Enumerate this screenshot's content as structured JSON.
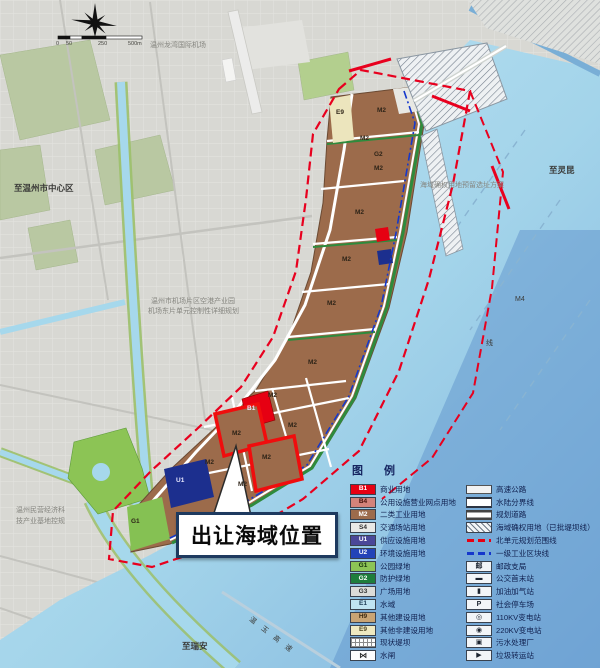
{
  "callout": {
    "text": "出让海域位置"
  },
  "scalebar": {
    "labels": [
      "0",
      "50",
      "250",
      "500m"
    ]
  },
  "map_labels": [
    {
      "text": "温州龙湾国际机场",
      "x": 150,
      "y": 42,
      "cls": "tiny gray"
    },
    {
      "text": "至灵昆",
      "x": 549,
      "y": 166,
      "cls": "small dark"
    },
    {
      "text": "至温州市中心区",
      "x": 14,
      "y": 184,
      "cls": "small dark"
    },
    {
      "text": "温州市机场片区空港产业园",
      "x": 151,
      "y": 298,
      "cls": "tiny gray"
    },
    {
      "text": "机场东片单元控制性详细规划",
      "x": 148,
      "y": 308,
      "cls": "tiny gray"
    },
    {
      "text": "温州民营经济科",
      "x": 16,
      "y": 507,
      "cls": "tiny gray"
    },
    {
      "text": "技产业基地控规",
      "x": 16,
      "y": 518,
      "cls": "tiny gray"
    },
    {
      "text": "至瑞安",
      "x": 182,
      "y": 642,
      "cls": "small dark"
    },
    {
      "text": "海域确权用地预留选址方案",
      "x": 420,
      "y": 182,
      "cls": "tiny gray"
    },
    {
      "text": "M4",
      "x": 515,
      "y": 296,
      "cls": "tiny dark"
    },
    {
      "text": "线",
      "x": 486,
      "y": 340,
      "cls": "tiny dark"
    },
    {
      "text": "温玉高速",
      "x": 252,
      "y": 616,
      "cls": "tiny dark",
      "rot": 38,
      "spacing": 8
    }
  ],
  "parcel_codes": [
    {
      "t": "E9",
      "x": 336,
      "y": 110
    },
    {
      "t": "M2",
      "x": 377,
      "y": 108
    },
    {
      "t": "M2",
      "x": 360,
      "y": 136
    },
    {
      "t": "G2",
      "x": 374,
      "y": 152
    },
    {
      "t": "M2",
      "x": 374,
      "y": 166
    },
    {
      "t": "M2",
      "x": 355,
      "y": 210
    },
    {
      "t": "M2",
      "x": 342,
      "y": 257
    },
    {
      "t": "M2",
      "x": 327,
      "y": 301
    },
    {
      "t": "M2",
      "x": 308,
      "y": 360
    },
    {
      "t": "M2",
      "x": 268,
      "y": 393
    },
    {
      "t": "B1",
      "x": 247,
      "y": 406,
      "light": true
    },
    {
      "t": "M2",
      "x": 288,
      "y": 423
    },
    {
      "t": "M2",
      "x": 232,
      "y": 431
    },
    {
      "t": "M2",
      "x": 262,
      "y": 455
    },
    {
      "t": "M2",
      "x": 205,
      "y": 460
    },
    {
      "t": "M2",
      "x": 238,
      "y": 482
    },
    {
      "t": "U1",
      "x": 176,
      "y": 478,
      "light": true
    },
    {
      "t": "G1",
      "x": 131,
      "y": 519
    }
  ],
  "legend": {
    "title": "图 例",
    "left": [
      {
        "code": "B1",
        "label": "商业用地",
        "swatch": "b1"
      },
      {
        "code": "B4",
        "label": "公用设施营业网点用地",
        "swatch": "b4"
      },
      {
        "code": "M2",
        "label": "二类工业用地",
        "swatch": "m2"
      },
      {
        "code": "S4",
        "label": "交通场站用地",
        "swatch": "s4"
      },
      {
        "code": "U1",
        "label": "供应设施用地",
        "swatch": "u1"
      },
      {
        "code": "U2",
        "label": "环境设施用地",
        "swatch": "u2"
      },
      {
        "code": "G1",
        "label": "公园绿地",
        "swatch": "g1"
      },
      {
        "code": "G2",
        "label": "防护绿地",
        "swatch": "g2"
      },
      {
        "code": "G3",
        "label": "广场用地",
        "swatch": "g3"
      },
      {
        "code": "E1",
        "label": "水域",
        "swatch": "e1"
      },
      {
        "code": "H9",
        "label": "其他建设用地",
        "swatch": "h9"
      },
      {
        "code": "E9",
        "label": "其他非建设用地",
        "swatch": "e9"
      },
      {
        "code": "",
        "label": "现状堤坝",
        "swatch": "dike"
      },
      {
        "code": "",
        "label": "水闸",
        "swatch": "gate",
        "glyph": "⋈"
      }
    ],
    "right": [
      {
        "label": "高速公路",
        "swatch": "highway"
      },
      {
        "label": "水陆分界线",
        "swatch": "waterline"
      },
      {
        "label": "规划道路",
        "swatch": "plannedroad"
      },
      {
        "label": "海域确权用地（已批堤坝线）",
        "swatch": "hatch"
      },
      {
        "label": "北单元规划范围线",
        "swatch": "reddash"
      },
      {
        "label": "一级工业区块线",
        "swatch": "bluedash"
      },
      {
        "label": "邮政支局",
        "swatch": "iconbox",
        "glyph": "邮"
      },
      {
        "label": "公交首末站",
        "swatch": "iconbox",
        "glyph": "▬"
      },
      {
        "label": "加油加气站",
        "swatch": "iconbox",
        "glyph": "▮"
      },
      {
        "label": "社会停车场",
        "swatch": "iconbox",
        "glyph": "P"
      },
      {
        "label": "110KV变电站",
        "swatch": "iconbox",
        "glyph": "◎"
      },
      {
        "label": "220KV变电站",
        "swatch": "iconbox",
        "glyph": "◉"
      },
      {
        "label": "污水处理厂",
        "swatch": "iconbox",
        "glyph": "▣"
      },
      {
        "label": "垃圾转运站",
        "swatch": "iconbox",
        "glyph": "▶"
      }
    ]
  },
  "colors": {
    "land": "#d8d8d3",
    "water_light": "#c2e6f4",
    "water_deep": "#7fb3dd",
    "industrial_m2": "#9c6b4b",
    "commercial_b1": "#e60012",
    "utility_navy": "#1c2f8e",
    "green_g1": "#85c153",
    "green_g2": "#2e8b3d",
    "boundary_red": "#e8001e",
    "block_line_blue": "#1538cc",
    "sale_outline": "#f00d0d",
    "callout_border": "#1e3a5f"
  }
}
